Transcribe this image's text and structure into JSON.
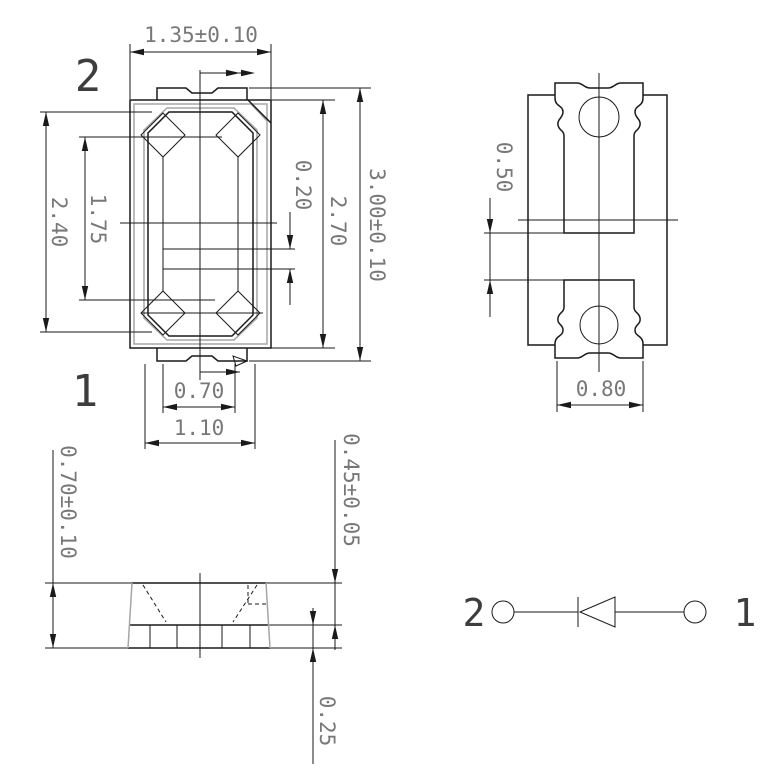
{
  "drawing_title": "SMD LED package outline drawing",
  "colors": {
    "line": "#1a1a1a",
    "grey": "#a6a6a6",
    "text": "#787878"
  },
  "top_view": {
    "label_pin2": "2",
    "label_pin1": "1",
    "dim_width": "1.35±0.10",
    "dim_reflector_height": "2.40",
    "dim_inner_height": "1.75",
    "dim_electrode_gap": "0.20",
    "dim_body_height": "2.70",
    "dim_total_height": "3.00±0.10",
    "dim_notch_width": "0.70",
    "dim_tab_width": "1.10"
  },
  "pad_view": {
    "dim_pad_gap": "0.50",
    "dim_pad_width": "0.80"
  },
  "side_view": {
    "dim_total_thickness": "0.70±0.10",
    "dim_upper_thickness": "0.45±0.05",
    "dim_standoff": "0.25"
  },
  "circuit": {
    "label_cathode": "2",
    "label_anode": "1"
  }
}
